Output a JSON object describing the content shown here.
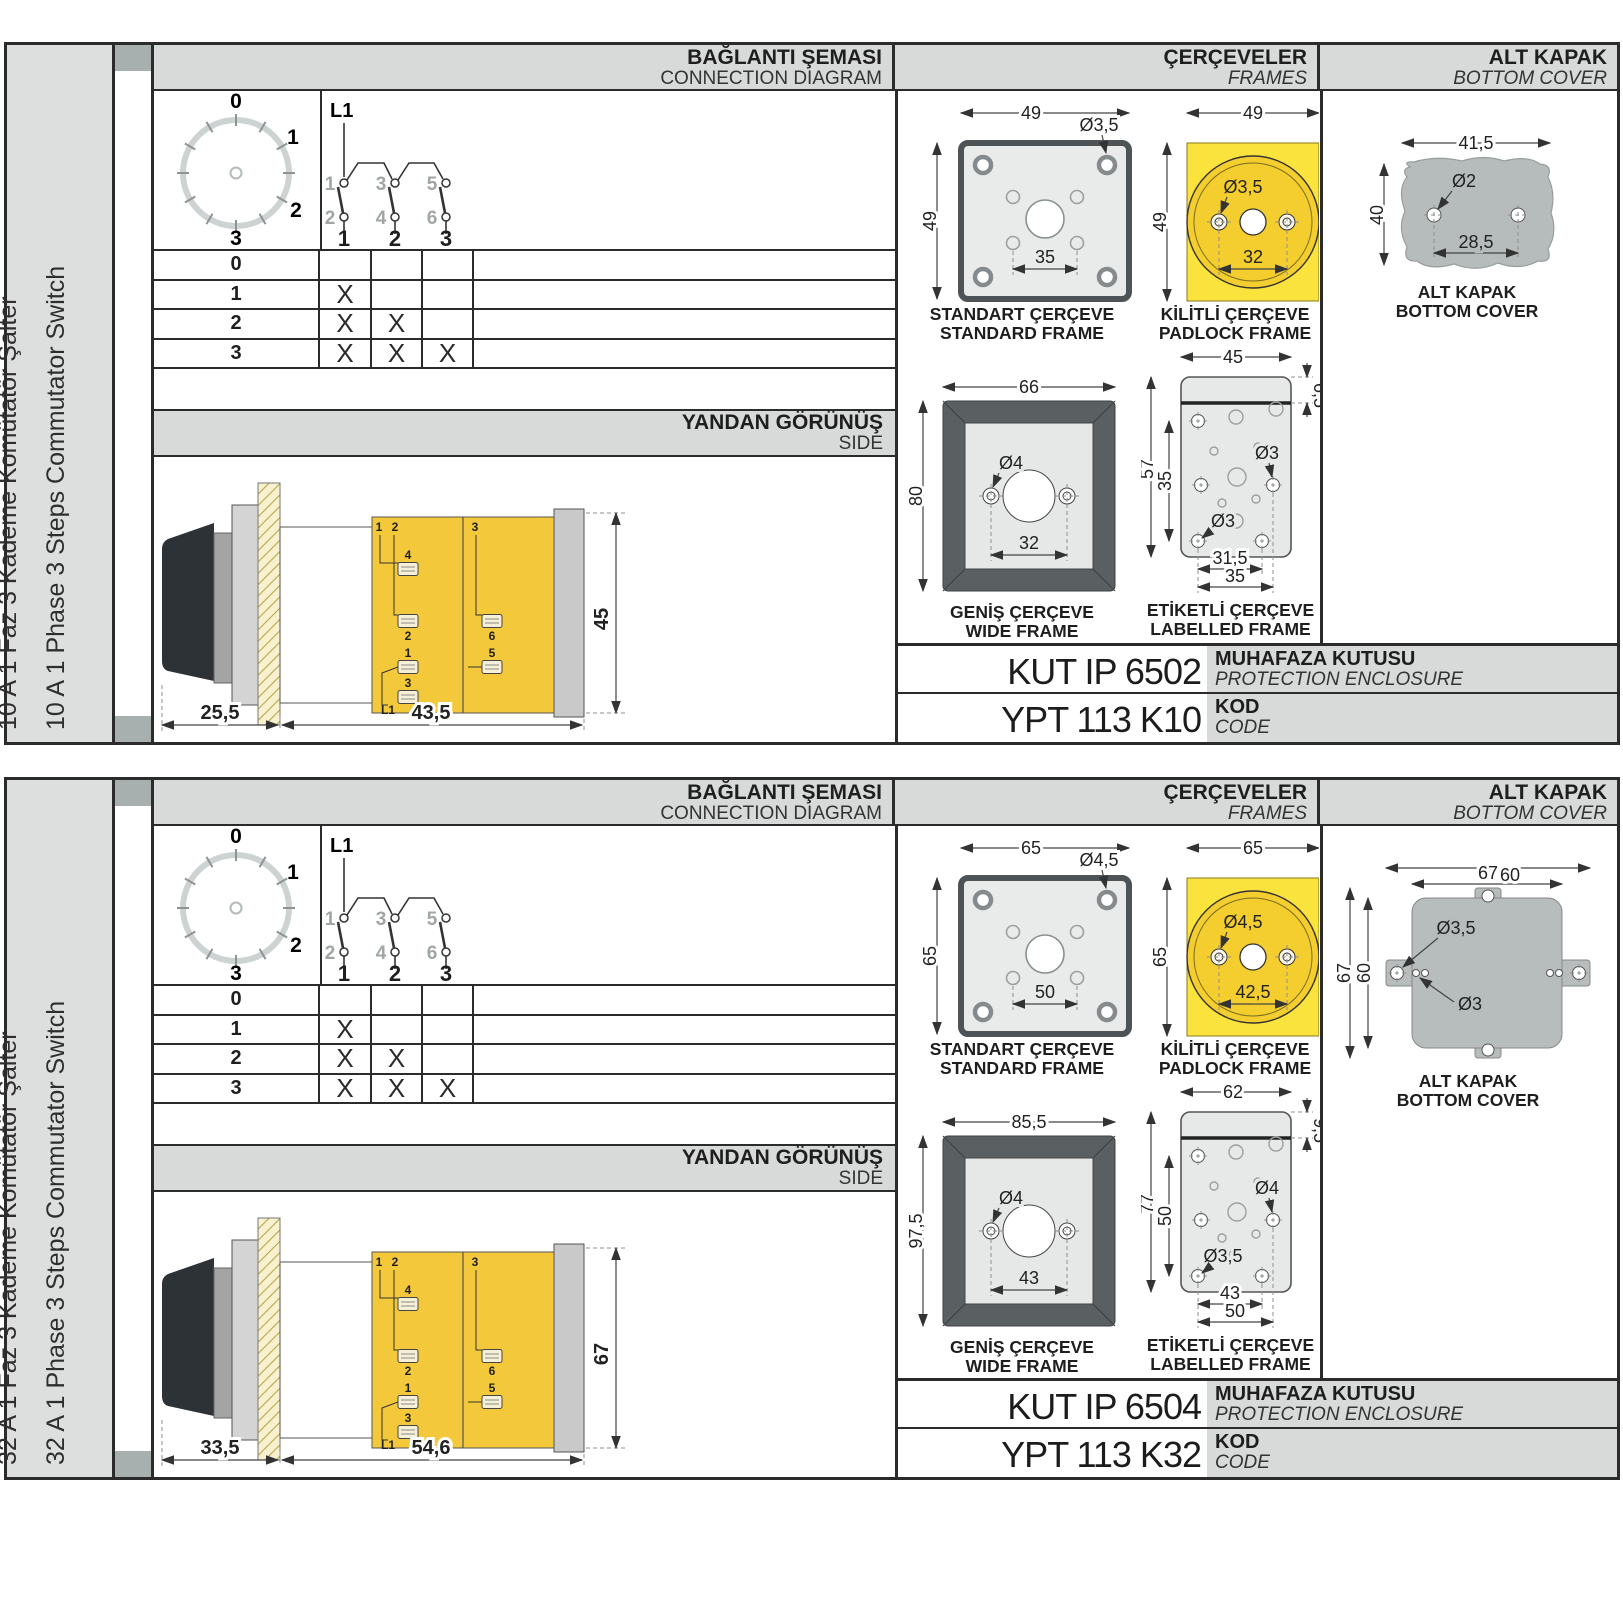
{
  "sections": [
    {
      "side_title_tr": "10 A 1 Faz 3 Kademe Komütatör Şalter",
      "side_title_en": "10 A 1 Phase 3 Steps Commutator Switch",
      "headers": {
        "connection_tr": "BAĞLANTI ŞEMASI",
        "connection_en": "CONNECTION DIAGRAM",
        "frames_tr": "ÇERÇEVELER",
        "frames_en": "FRAMES",
        "cover_tr": "ALT KAPAK",
        "cover_en": "BOTTOM COVER"
      },
      "dial": {
        "labels": [
          "0",
          "1",
          "2",
          "3"
        ]
      },
      "schematic": {
        "phase": "L1",
        "contacts_top": [
          "1",
          "3",
          "5"
        ],
        "contacts_bottom": [
          "2",
          "4",
          "6"
        ],
        "outputs": [
          "1",
          "2",
          "3"
        ]
      },
      "table": {
        "rows": [
          {
            "step": "0",
            "marks": [
              "",
              "",
              ""
            ]
          },
          {
            "step": "1",
            "marks": [
              "X",
              "",
              ""
            ]
          },
          {
            "step": "2",
            "marks": [
              "X",
              "X",
              ""
            ]
          },
          {
            "step": "3",
            "marks": [
              "X",
              "X",
              "X"
            ]
          }
        ]
      },
      "side": {
        "title_tr": "YANDAN GÖRÜNÜŞ",
        "title_en": "SIDE",
        "dim_front": "25,5",
        "dim_body": "43,5",
        "dim_height": "45",
        "wiring": {
          "a": "1",
          "b": "2",
          "c": "3",
          "t4": "4",
          "t2": "2",
          "t6": "6",
          "t1": "1",
          "t5": "5",
          "t3": "3",
          "feed": "L1"
        }
      },
      "frames": {
        "standard": {
          "label_tr": "STANDART ÇERÇEVE",
          "label_en": "STANDARD FRAME",
          "w": "49",
          "h": "49",
          "hole": "Ø3,5",
          "pitch": "35"
        },
        "padlock": {
          "label_tr": "KİLİTLİ ÇERÇEVE",
          "label_en": "PADLOCK FRAME",
          "w": "49",
          "h": "49",
          "hole": "Ø3,5",
          "pitch": "32"
        },
        "wide": {
          "label_tr": "GENİŞ ÇERÇEVE",
          "label_en": "WIDE FRAME",
          "w": "66",
          "h": "80",
          "hole": "Ø4",
          "pitch": "32"
        },
        "labelled": {
          "label_tr": "ETİKETLİ ÇERÇEVE",
          "label_en": "LABELLED FRAME",
          "w": "45",
          "strip": "6,5",
          "h": "57",
          "h2": "35",
          "hole_r": "Ø3",
          "hole_l": "Ø3",
          "pitch1": "31,5",
          "pitch2": "35"
        }
      },
      "cover": {
        "label_tr": "ALT KAPAK",
        "label_en": "BOTTOM COVER",
        "w": "41,5",
        "h": "40",
        "hole": "Ø2",
        "pitch": "28,5"
      },
      "codes": {
        "enclosure": "KUT IP 6502",
        "enclosure_tr": "MUHAFAZA KUTUSU",
        "enclosure_en": "PROTECTION ENCLOSURE",
        "code": "YPT 113 K10",
        "code_tr": "KOD",
        "code_en": "CODE"
      }
    },
    {
      "side_title_tr": "32 A 1 Faz 3 Kademe Komütatör Şalter",
      "side_title_en": "32 A 1 Phase 3 Steps Commutator Switch",
      "headers": {
        "connection_tr": "BAĞLANTI ŞEMASI",
        "connection_en": "CONNECTION DIAGRAM",
        "frames_tr": "ÇERÇEVELER",
        "frames_en": "FRAMES",
        "cover_tr": "ALT KAPAK",
        "cover_en": "BOTTOM COVER"
      },
      "dial": {
        "labels": [
          "0",
          "1",
          "2",
          "3"
        ]
      },
      "schematic": {
        "phase": "L1",
        "contacts_top": [
          "1",
          "3",
          "5"
        ],
        "contacts_bottom": [
          "2",
          "4",
          "6"
        ],
        "outputs": [
          "1",
          "2",
          "3"
        ]
      },
      "table": {
        "rows": [
          {
            "step": "0",
            "marks": [
              "",
              "",
              ""
            ]
          },
          {
            "step": "1",
            "marks": [
              "X",
              "",
              ""
            ]
          },
          {
            "step": "2",
            "marks": [
              "X",
              "X",
              ""
            ]
          },
          {
            "step": "3",
            "marks": [
              "X",
              "X",
              "X"
            ]
          }
        ]
      },
      "side": {
        "title_tr": "YANDAN GÖRÜNÜŞ",
        "title_en": "SIDE",
        "dim_front": "33,5",
        "dim_body": "54,6",
        "dim_height": "67",
        "wiring": {
          "a": "1",
          "b": "2",
          "c": "3",
          "t4": "4",
          "t2": "2",
          "t6": "6",
          "t1": "1",
          "t5": "5",
          "t3": "3",
          "feed": "L1"
        }
      },
      "frames": {
        "standard": {
          "label_tr": "STANDART ÇERÇEVE",
          "label_en": "STANDARD FRAME",
          "w": "65",
          "h": "65",
          "hole": "Ø4,5",
          "pitch": "50"
        },
        "padlock": {
          "label_tr": "KİLİTLİ ÇERÇEVE",
          "label_en": "PADLOCK FRAME",
          "w": "65",
          "h": "65",
          "hole": "Ø4,5",
          "pitch": "42,5"
        },
        "wide": {
          "label_tr": "GENİŞ ÇERÇEVE",
          "label_en": "WIDE FRAME",
          "w": "85,5",
          "h": "97,5",
          "hole": "Ø4",
          "pitch": "43"
        },
        "labelled": {
          "label_tr": "ETİKETLİ ÇERÇEVE",
          "label_en": "LABELLED FRAME",
          "w": "62",
          "strip": "9,5",
          "h": "77",
          "h2": "50",
          "hole_r": "Ø4",
          "hole_l": "Ø3,5",
          "pitch1": "43",
          "pitch2": "50"
        }
      },
      "cover": {
        "label_tr": "ALT KAPAK",
        "label_en": "BOTTOM COVER",
        "w": "67",
        "w2": "60",
        "h": "67",
        "h2": "60",
        "hole": "Ø3,5",
        "hole2": "Ø3"
      },
      "codes": {
        "enclosure": "KUT IP 6504",
        "enclosure_tr": "MUHAFAZA KUTUSU",
        "enclosure_en": "PROTECTION ENCLOSURE",
        "code": "YPT 113 K32",
        "code_tr": "KOD",
        "code_en": "CODE"
      }
    }
  ]
}
